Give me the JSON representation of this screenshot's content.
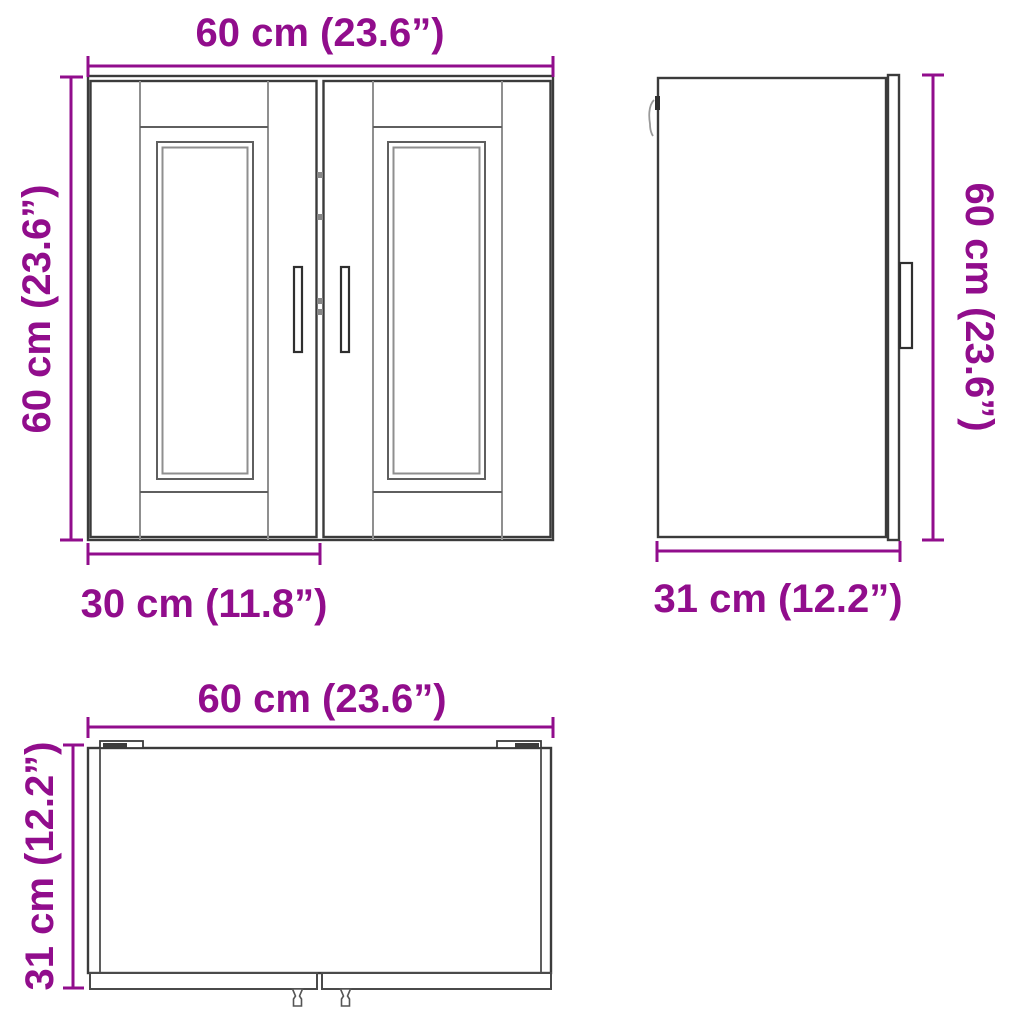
{
  "diagram": {
    "accent_color": "#910d8c",
    "line_color": "#3b3b3b",
    "views": {
      "front": {
        "width_label": "60 cm (23.6”)",
        "height_label": "60 cm (23.6”)",
        "door_width_label": "30 cm (11.8”)"
      },
      "side": {
        "height_label": "60 cm (23.6”)",
        "depth_label": "31 cm (12.2”)"
      },
      "top": {
        "width_label": "60 cm (23.6”)",
        "depth_label": "31 cm (12.2”)"
      }
    }
  }
}
